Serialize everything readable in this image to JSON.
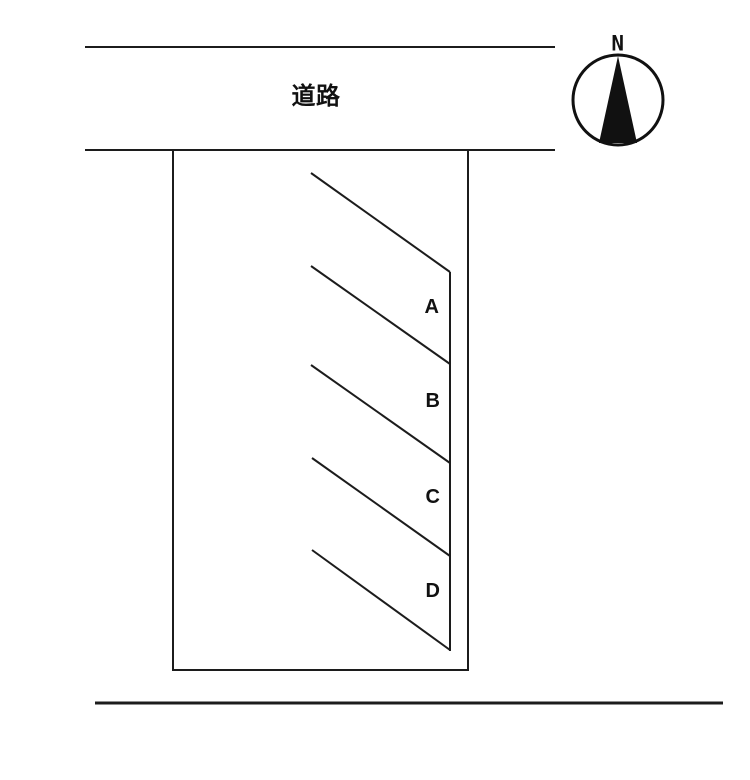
{
  "diagram": {
    "background_color": "#ffffff",
    "line_color": "#1c1c1c",
    "road": {
      "label": "道路"
    },
    "compass": {
      "label": "N"
    },
    "plots": [
      {
        "label": "A"
      },
      {
        "label": "B"
      },
      {
        "label": "C"
      },
      {
        "label": "D"
      }
    ]
  }
}
